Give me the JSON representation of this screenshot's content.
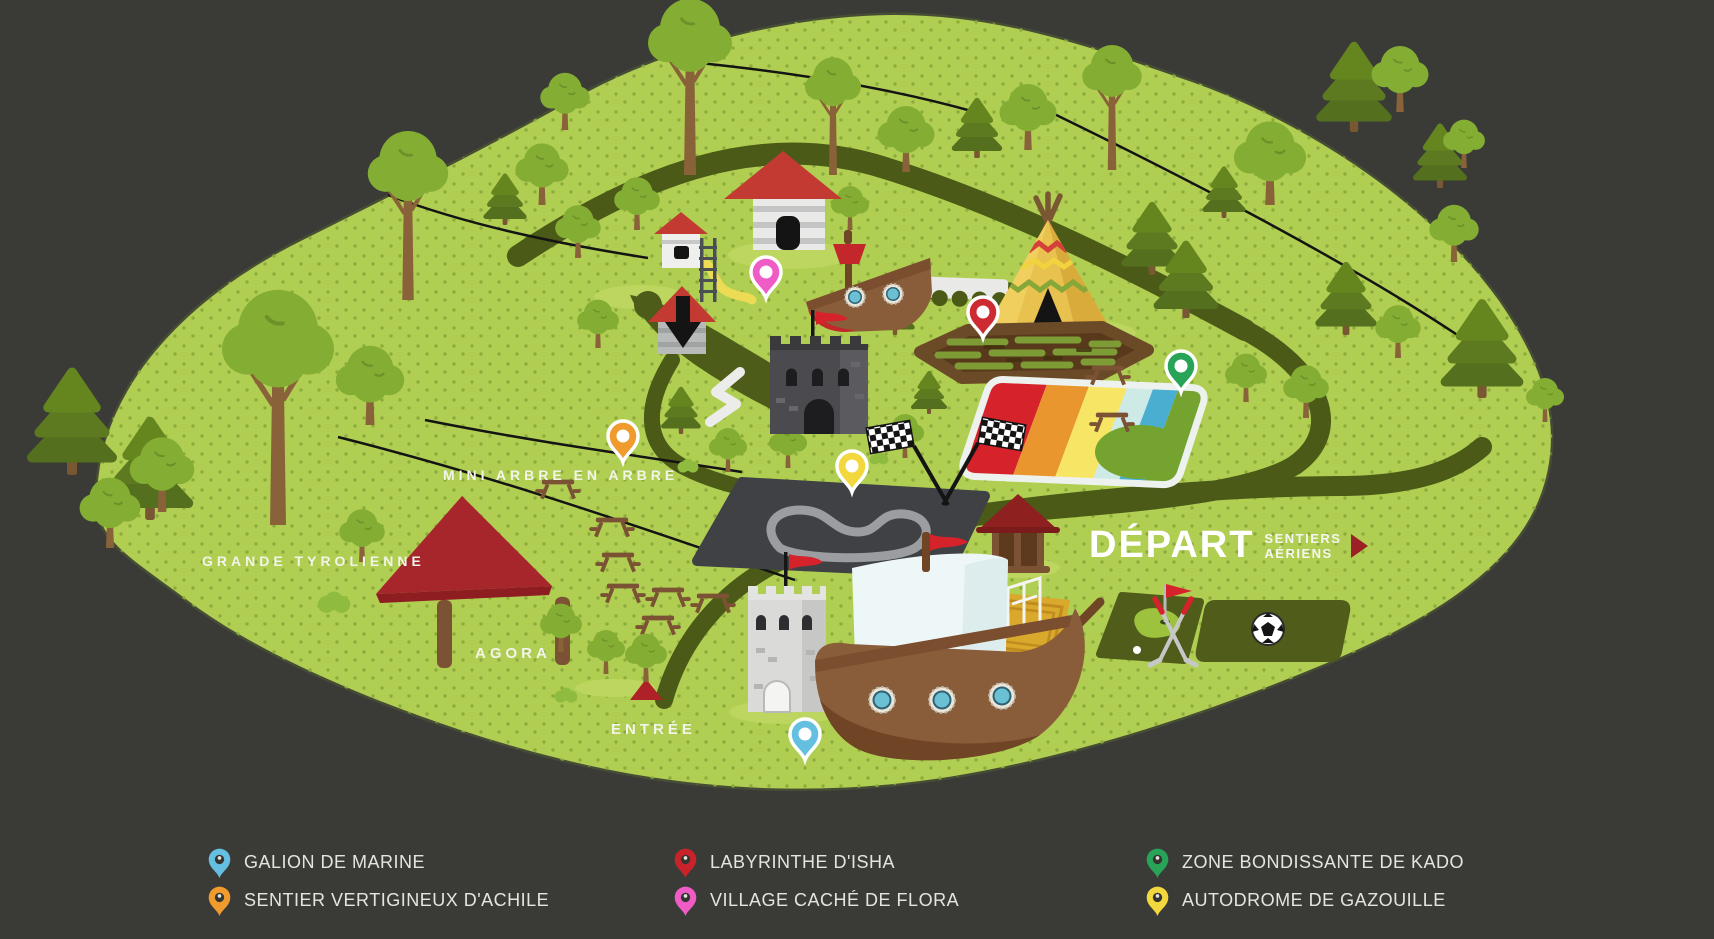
{
  "colors": {
    "background": "#3a3b37",
    "ground": "#b0cf52",
    "ground_dots": "#8cab3d",
    "path": "#4b5a17",
    "label_text": "#f2f4ea",
    "depart_arrow": "#9c2127"
  },
  "map": {
    "area_labels": {
      "grande_tyrolienne": "GRANDE TYROLIENNE",
      "mini_arbre": "MINI ARBRE EN ARBRE",
      "agora": "AGORA",
      "entree": "ENTRÉE"
    },
    "depart": {
      "title": "DÉPART",
      "line1": "SENTIERS",
      "line2": "AÉRIENS"
    },
    "pins": [
      {
        "name": "VILLAGE CACHÉ DE FLORA",
        "color": "#f05cc6"
      },
      {
        "name": "LABYRINTHE D'ISHA",
        "color": "#cd2a31"
      },
      {
        "name": "ZONE BONDISSANTE DE KADO",
        "color": "#27a457"
      },
      {
        "name": "AUTODROME DE GAZOUILLE",
        "color": "#f2d83c"
      },
      {
        "name": "SENTIER VERTIGINEUX D'ACHILE",
        "color": "#ef9b2d"
      },
      {
        "name": "GALION DE MARINE",
        "color": "#64bfe0"
      }
    ]
  },
  "legend": {
    "items": [
      {
        "label": "GALION DE MARINE",
        "color": "#64bfe0"
      },
      {
        "label": "SENTIER VERTIGINEUX D'ACHILE",
        "color": "#ef9b2d"
      },
      {
        "label": "LABYRINTHE D'ISHA",
        "color": "#c8232b"
      },
      {
        "label": "VILLAGE CACHÉ DE FLORA",
        "color": "#f05cc6"
      },
      {
        "label": "ZONE BONDISSANTE DE KADO",
        "color": "#27a457"
      },
      {
        "label": "AUTODROME DE GAZOUILLE",
        "color": "#f2d83c"
      }
    ]
  }
}
